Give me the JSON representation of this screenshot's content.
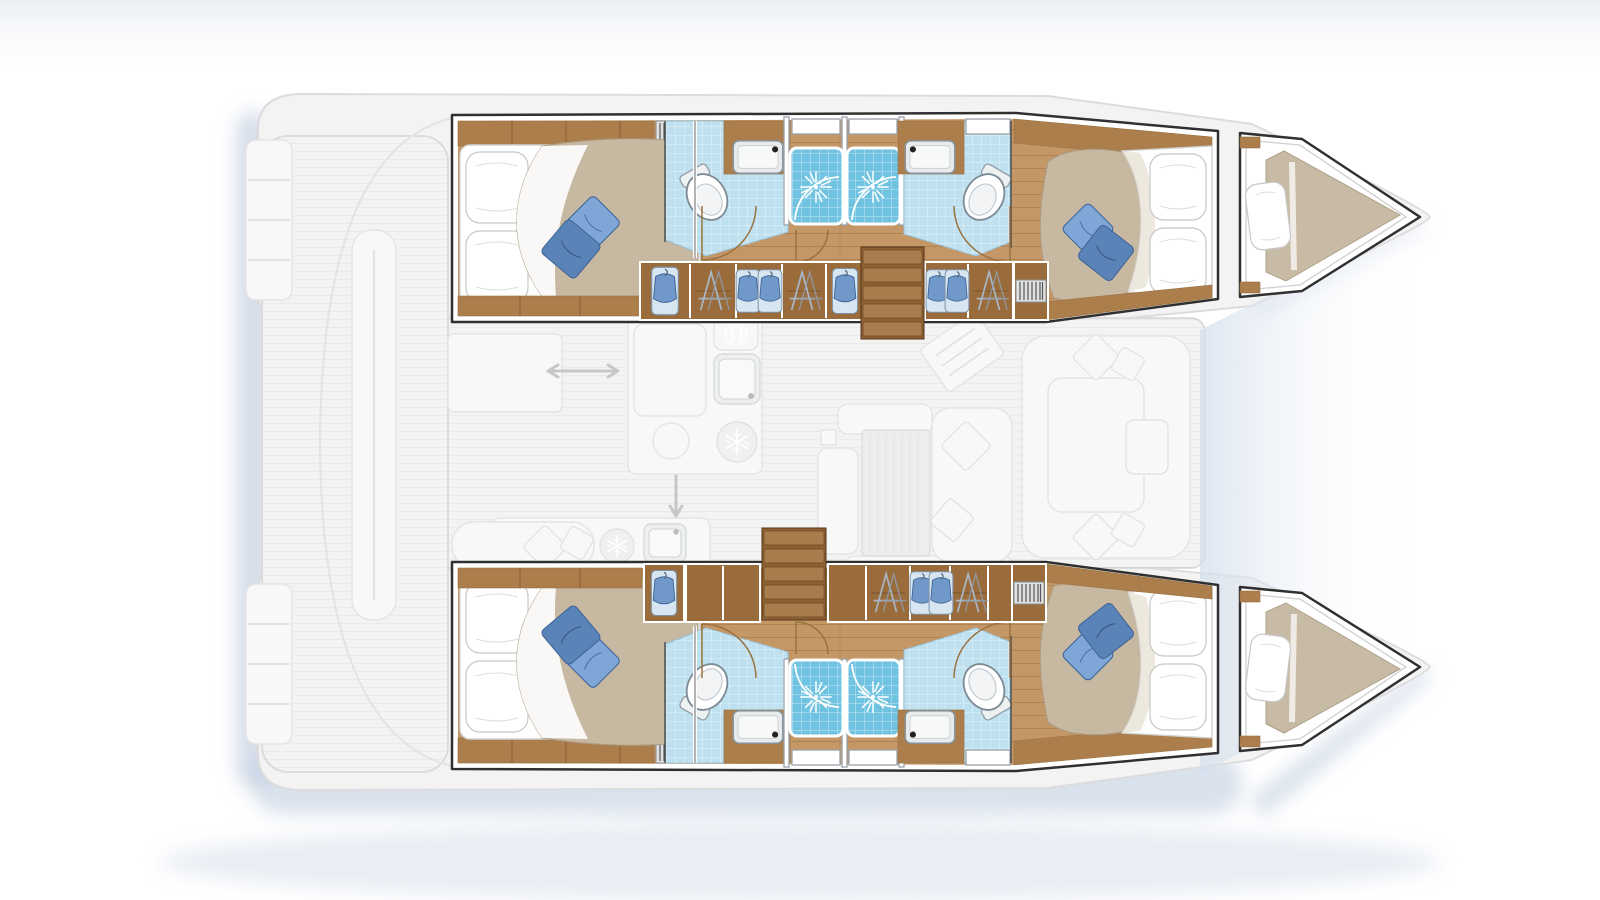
{
  "meta": {
    "title": "Catamaran 4-cabin layout floor plan",
    "view": "top-down plan",
    "orientation": "bow-right, stern-left",
    "style": "rendered yacht brochure layout: hull interiors highlighted in colour, deck and saloon ghosted in light grey"
  },
  "palette": {
    "hullOutline": "#303030",
    "ghostFill": "#f3f3f4",
    "ghostLine": "#dcdcdd",
    "ghostItem": "#f8f8f9",
    "ghostStroke": "#e4e4e6",
    "wood": "#c49767",
    "woodLine": "#9a7240",
    "woodCab": "#ab7e4b",
    "woodDark": "#9a6c3c",
    "stepWood": "#8c6031",
    "stepTread": "#a97c4d",
    "duvet": "#c6b8a1",
    "duvetShade": "#ab9c84",
    "cushionLight": "#7ea7d7",
    "cushionDark": "#5a84b8",
    "cushionEdge": "#3d6296",
    "tilePale": "#bfe0ef",
    "tileBlue": "#6fc3e0",
    "fixtureLine": "#8696a2",
    "shadow": "#b4c3d9",
    "sky": "#e8ecf2"
  },
  "vessel": {
    "type": "sailing catamaran",
    "hulls": 2,
    "double_cabins": 4,
    "bathrooms": 4,
    "shower_cubicles": 4,
    "forepeak_berths": 2,
    "companionway_stairs": 2
  },
  "compartments": {
    "port_hull": [
      "aft double cabin",
      "aft bathroom with toilet and washbasin",
      "shower cubicle",
      "shower cubicle",
      "forward bathroom with toilet and washbasin",
      "forward double cabin",
      "forepeak berth"
    ],
    "starboard_hull": [
      "aft double cabin",
      "aft bathroom with toilet and washbasin",
      "shower cubicle",
      "shower cubicle",
      "forward bathroom with toilet and washbasin",
      "forward double cabin",
      "forepeak berth"
    ],
    "main_deck_ghosted": [
      "aft cockpit with transom steps",
      "saloon",
      "galley with sinks, stove and fridges",
      "dining table with sofa",
      "chart table",
      "forward cockpit seating",
      "trampoline area"
    ]
  },
  "icons": [
    "toilet-icon",
    "sink-icon",
    "shower-spray-icon",
    "vent-grille-icon",
    "hanger-icon",
    "garment-icon",
    "snowflake-fridge-icon",
    "cutlery-icon",
    "double-arrow-icon",
    "door-swing-arc",
    "companionway-steps"
  ]
}
